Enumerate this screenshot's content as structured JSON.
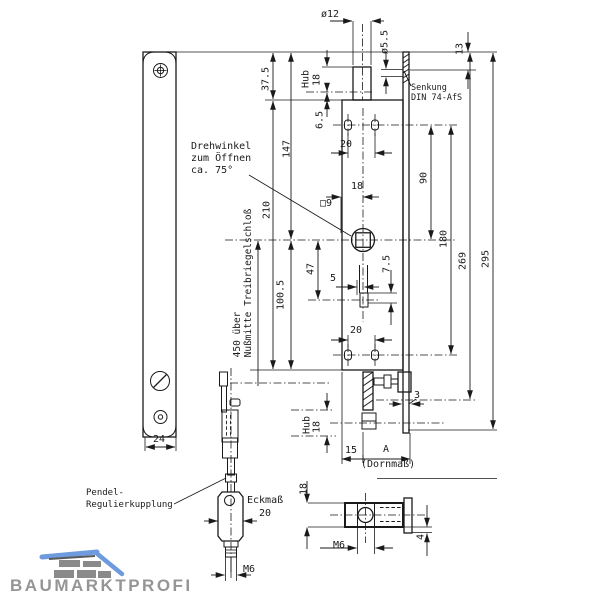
{
  "page": {
    "background": "#ffffff",
    "line_color": "#1a1a1a"
  },
  "logo": {
    "text": "BAUMARKTPROFI",
    "roof_color": "#6e9ade",
    "brick_color": "#8a8a8a",
    "text_color": "#959595"
  },
  "labels": {
    "drehwinkel": [
      "Drehwinkel",
      "zum Öffnen",
      "ca. 75°"
    ],
    "senkung": [
      "Senkung",
      "DIN 74-AfS"
    ],
    "nussmitte": [
      "450 über",
      "Nußmitte Treibriegelschloß"
    ],
    "pendel": [
      "Pendel-",
      "Regulierkupplung"
    ],
    "dornmass": "(Dornmaß)",
    "eckmass": "Eckmaß"
  },
  "dimensions": {
    "rod_diameter": "ø12",
    "hole_diameter": "ø5.5",
    "hub_top_label": "Hub",
    "hub_top_value": "18",
    "offset_6_5": "6.5",
    "plate_to_case": "37.5",
    "d147": "147",
    "d210": "210",
    "d100_5": "100.5",
    "d47": "47",
    "top_holes_spacing": "20",
    "nut_offset": "18",
    "square_9": "□9",
    "pin_offset": "5",
    "pin_size": "7.5",
    "bottom_holes_spacing": "20",
    "d13": "13",
    "d90": "90",
    "d180": "180",
    "d269": "269",
    "d295": "295",
    "hub_bottom_label": "Hub",
    "hub_bottom_value": "18",
    "faceplate_thickness": "3",
    "d15": "15",
    "dA": "A",
    "plate_width": "24",
    "eckmass_value": "20",
    "coupling_thread": "M6",
    "side_height": "18",
    "side_thread": "M6",
    "side_offset": "4"
  }
}
